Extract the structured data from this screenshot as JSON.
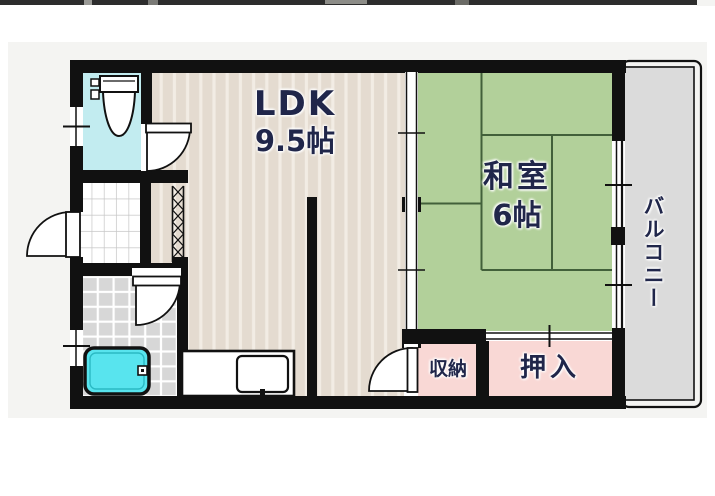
{
  "floorplan": {
    "labels": {
      "ldk_name": "LDK",
      "ldk_size": "9.5帖",
      "washitsu_name": "和室",
      "washitsu_size": "6帖",
      "balcony": "バルコニー",
      "storage": "収納",
      "closet": "押入"
    },
    "colors": {
      "wall": "#111111",
      "panel": "#f4f4f2",
      "ldk_floor": "#e4dbd0",
      "ldk_stripe": "#f2ece4",
      "tatami_green": "#b2d09a",
      "tatami_line": "#42603a",
      "balcony_gray": "#dbdbdb",
      "closet_pink": "#f9d8d5",
      "toilet_cyan": "#c2ecf0",
      "bathtub_cyan": "#58e4ee",
      "bath_tile_gray": "#d7d7d7",
      "label_navy": "#20264a",
      "top_strip": "#2d2d2d"
    }
  }
}
